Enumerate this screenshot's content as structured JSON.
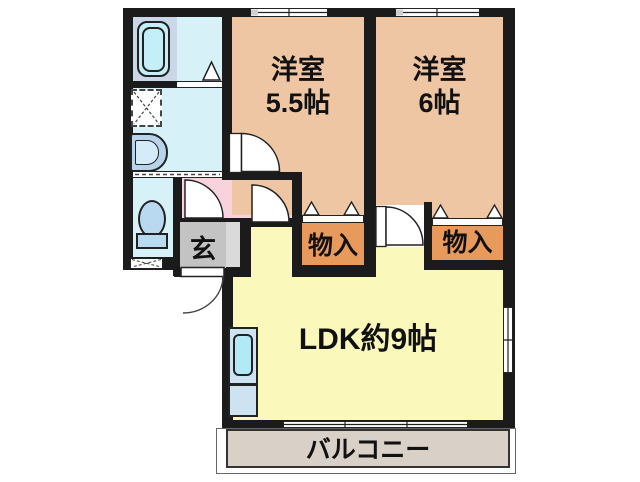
{
  "labels": {
    "bedroom1_name": "洋室",
    "bedroom1_size": "5.5帖",
    "bedroom2_name": "洋室",
    "bedroom2_size": "6帖",
    "ldk": "LDK約9帖",
    "closet_left": "物入",
    "closet_right": "物入",
    "entrance": "玄",
    "balcony": "バルコニー"
  },
  "colors": {
    "wall": "#1b1b1b",
    "bedroom": "#eec6a4",
    "closet": "#e8995c",
    "ldk": "#fbf8bc",
    "hallway": "#f8d3de",
    "wet_area_floor": "#d6f2f8",
    "bathtub_zone": "#c9d7e9",
    "entrance_gray": "#c3c3c3",
    "entrance_step": "#dadada",
    "balcony": "#d9d0c7",
    "fixture_blue": "#b9d9f0",
    "kitchen_counter": "#cde3f2",
    "sink_cyan": "#b2e9f6"
  },
  "fixtures": {
    "bathtub": "bathtub-icon",
    "washing_machine_space": "washing-machine-space-icon",
    "washbasin": "washbasin-icon",
    "toilet": "toilet-icon",
    "kitchen_sink": "kitchen-sink-icon"
  }
}
